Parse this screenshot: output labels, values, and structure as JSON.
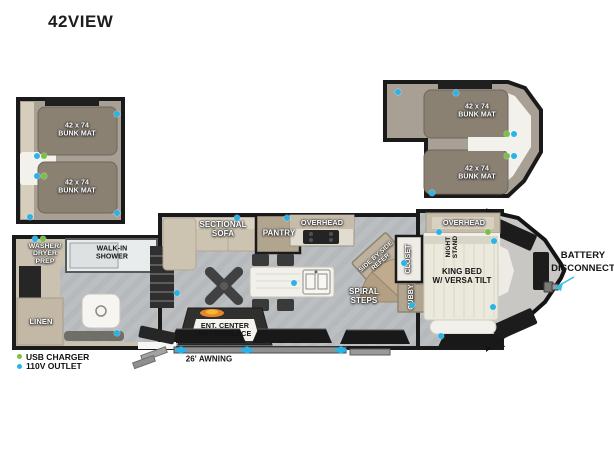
{
  "title": "42VIEW",
  "legend": {
    "usb_label": "USB CHARGER",
    "outlet_label": "110V OUTLET"
  },
  "awning_label": "26' AWNING",
  "battery_label": "BATTERY\nDISCONNECT",
  "loft_left": {
    "mat1": "42 x 74\nBUNK MAT",
    "mat2": "42 x 74\nBUNK MAT"
  },
  "loft_right": {
    "mat1": "42 x 74\nBUNK MAT",
    "mat2": "42 x 74\nBUNK MAT"
  },
  "labels": {
    "washer_dryer": "WASHER/\nDRYER\nPREP",
    "walk_in_shower": "WALK-IN\nSHOWER",
    "linen": "LINEN",
    "sectional_sofa": "SECTIONAL\nSOFA",
    "pantry": "PANTRY",
    "overhead_kitchen": "OVERHEAD",
    "side_by_side_refer": "SIDE BY SIDE\nREFER",
    "closet": "CLOSET",
    "cubby": "CUBBY",
    "spiral_steps": "SPIRAL\nSTEPS",
    "ent_center": "ENT. CENTER\nW/ FIREPLACE",
    "night_stand": "NIGHT\nSTAND",
    "king_bed": "KING BED\nW/ VERSA TILT",
    "overhead_bedroom": "OVERHEAD"
  },
  "colors": {
    "outlet": "#2ab3e6",
    "usb": "#7ac143"
  },
  "outlets": [
    {
      "type": "outlet",
      "x": 117,
      "y": 114
    },
    {
      "type": "outlet",
      "x": 117,
      "y": 213
    },
    {
      "type": "outlet",
      "x": 30,
      "y": 217
    },
    {
      "type": "outlet",
      "x": 37,
      "y": 156
    },
    {
      "type": "usb",
      "x": 44,
      "y": 156
    },
    {
      "type": "outlet",
      "x": 37,
      "y": 176
    },
    {
      "type": "usb",
      "x": 44,
      "y": 176
    },
    {
      "type": "outlet",
      "x": 398,
      "y": 92
    },
    {
      "type": "outlet",
      "x": 456,
      "y": 93
    },
    {
      "type": "outlet",
      "x": 432,
      "y": 193
    },
    {
      "type": "usb",
      "x": 507,
      "y": 134
    },
    {
      "type": "outlet",
      "x": 514,
      "y": 134
    },
    {
      "type": "usb",
      "x": 507,
      "y": 156
    },
    {
      "type": "outlet",
      "x": 514,
      "y": 156
    },
    {
      "type": "outlet",
      "x": 35,
      "y": 239
    },
    {
      "type": "usb",
      "x": 43,
      "y": 239
    },
    {
      "type": "outlet",
      "x": 117,
      "y": 333
    },
    {
      "type": "outlet",
      "x": 237,
      "y": 218
    },
    {
      "type": "outlet",
      "x": 287,
      "y": 218
    },
    {
      "type": "outlet",
      "x": 177,
      "y": 293
    },
    {
      "type": "outlet",
      "x": 294,
      "y": 283
    },
    {
      "type": "outlet",
      "x": 404,
      "y": 263
    },
    {
      "type": "outlet",
      "x": 412,
      "y": 305
    },
    {
      "type": "outlet",
      "x": 439,
      "y": 232
    },
    {
      "type": "usb",
      "x": 488,
      "y": 232
    },
    {
      "type": "outlet",
      "x": 494,
      "y": 241
    },
    {
      "type": "outlet",
      "x": 493,
      "y": 307
    },
    {
      "type": "outlet",
      "x": 441,
      "y": 336
    }
  ]
}
